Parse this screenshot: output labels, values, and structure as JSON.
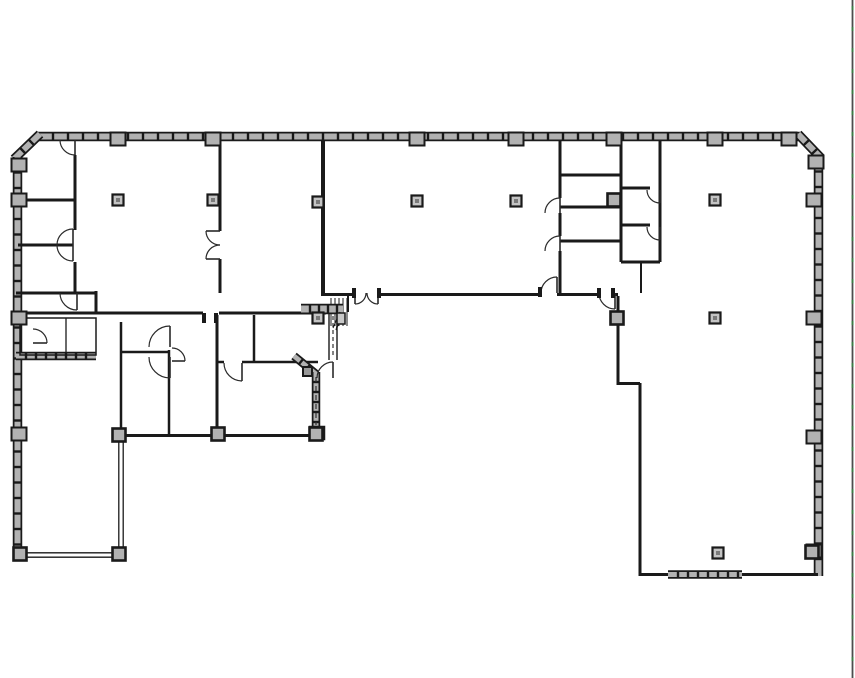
{
  "drawing": {
    "type": "floor-plan",
    "canvas": {
      "width": 855,
      "height": 678,
      "background": "#ffffff"
    },
    "colors": {
      "wall_line": "#1a1a1a",
      "hatch_fill": "#b2b2b2",
      "column_fill": "#c4c4c4",
      "column_core": "#7a7a7a",
      "door_arc": "#2a2a2a",
      "border_line": "#4d4d4d",
      "border_dash": "#3a7d44"
    },
    "exterior_walls": [
      {
        "x1": 38,
        "y1": 136.5,
        "x2": 800,
        "y2": 136.5,
        "w": 7,
        "tick": 15
      },
      {
        "x1": 40,
        "y1": 134,
        "x2": 14,
        "y2": 159,
        "w": 7,
        "tick": 12
      },
      {
        "x1": 17.5,
        "y1": 157,
        "x2": 17.5,
        "y2": 555,
        "w": 7,
        "tick": 15.5
      },
      {
        "x1": 798,
        "y1": 134,
        "x2": 821,
        "y2": 158,
        "w": 7,
        "tick": 12
      },
      {
        "x1": 818.5,
        "y1": 156,
        "x2": 818.5,
        "y2": 576,
        "w": 7,
        "tick": 15.5
      }
    ],
    "hatch_overlays": [
      {
        "x1": 301,
        "y1": 309,
        "x2": 343,
        "y2": 309,
        "w": 8,
        "tick": 9
      },
      {
        "x1": 294,
        "y1": 356,
        "x2": 316,
        "y2": 374,
        "w": 6,
        "tick": 9
      },
      {
        "x1": 316,
        "y1": 372,
        "x2": 316,
        "y2": 430,
        "w": 6,
        "tick": 10
      },
      {
        "x1": 668,
        "y1": 574.5,
        "x2": 742,
        "y2": 574.5,
        "w": 6,
        "tick": 10
      },
      {
        "x1": 16,
        "y1": 356,
        "x2": 96,
        "y2": 356,
        "w": 6,
        "tick": 10
      }
    ],
    "interior_walls": [
      [
        75,
        155,
        75,
        230
      ],
      [
        75,
        262,
        75,
        294
      ],
      [
        21,
        200,
        75,
        200
      ],
      [
        18,
        245,
        73,
        245
      ],
      [
        16,
        293,
        96,
        293
      ],
      [
        96,
        291,
        96,
        314
      ],
      [
        16,
        313,
        203,
        313
      ],
      [
        219,
        313,
        326,
        313
      ],
      [
        121,
        322,
        121,
        437,
        2.5
      ],
      [
        122,
        352,
        169,
        352,
        2.5
      ],
      [
        169,
        350,
        169,
        437,
        2.5
      ],
      [
        217,
        315,
        217,
        437
      ],
      [
        217,
        362,
        224,
        362,
        2.5
      ],
      [
        242,
        362,
        318,
        362,
        2.5
      ],
      [
        254,
        315,
        254,
        362,
        2.5
      ],
      [
        122,
        435.5,
        323,
        435.5
      ],
      [
        220,
        140,
        220,
        231
      ],
      [
        220,
        259,
        220,
        293
      ],
      [
        323,
        140,
        323,
        296,
        4
      ],
      [
        325,
        294.5,
        355,
        294.5
      ],
      [
        378,
        294.5,
        541,
        294.5
      ],
      [
        557,
        294.5,
        563,
        294.5
      ],
      [
        560,
        140,
        560,
        198
      ],
      [
        560,
        213,
        560,
        236
      ],
      [
        560,
        251,
        560,
        296
      ],
      [
        560,
        175,
        621,
        175
      ],
      [
        560,
        207,
        621,
        207
      ],
      [
        560,
        241,
        621,
        241
      ],
      [
        560,
        294.5,
        599,
        294.5
      ],
      [
        613,
        294.5,
        618,
        294.5
      ],
      [
        621,
        140,
        621,
        262
      ],
      [
        660,
        140,
        660,
        262
      ],
      [
        621,
        188,
        650,
        188
      ],
      [
        621,
        225,
        650,
        225
      ],
      [
        621,
        262,
        660,
        262
      ],
      [
        641,
        262,
        641,
        293,
        2
      ],
      [
        618,
        296,
        618,
        385
      ],
      [
        618,
        383.5,
        640,
        383.5
      ],
      [
        640,
        383,
        640,
        576
      ],
      [
        640,
        574.5,
        818,
        574.5
      ]
    ],
    "thin_lines": [
      [
        66,
        318,
        66,
        355,
        1.3
      ],
      [
        329,
        313,
        329,
        360,
        1.4
      ],
      [
        337,
        313,
        337,
        360,
        1.4
      ],
      [
        348,
        296,
        348,
        312,
        2
      ],
      [
        118.8,
        437,
        118.8,
        556,
        1.3
      ],
      [
        123.2,
        437,
        123.2,
        556,
        1.3
      ],
      [
        16,
        552.8,
        122,
        552.8,
        1.4
      ],
      [
        16,
        557.2,
        122,
        557.2,
        1.4
      ],
      [
        331,
        298,
        331,
        326,
        1
      ],
      [
        335,
        298,
        335,
        326,
        1
      ],
      [
        339,
        298,
        339,
        326,
        1
      ],
      [
        343,
        298,
        343,
        326,
        1
      ],
      [
        347,
        298,
        347,
        326,
        1
      ]
    ],
    "dashed_lines": [
      [
        333,
        316,
        333,
        357,
        "4 3"
      ],
      [
        316,
        377,
        316,
        425,
        "5 4"
      ]
    ],
    "polylines": [
      {
        "points": [
          [
            333,
            328
          ],
          [
            340,
            312
          ],
          [
            336,
            330
          ],
          [
            343,
            314
          ]
        ],
        "w": 1
      }
    ],
    "rects": [
      {
        "x": 20,
        "y": 318,
        "w": 76,
        "h": 37,
        "fill": "none",
        "stroke": 1.5
      },
      {
        "x": 337,
        "y": 313,
        "w": 8,
        "h": 11,
        "fill": "#c8c8c8",
        "stroke": 1.5
      },
      {
        "x": 310,
        "y": 427,
        "w": 14,
        "h": 12,
        "fill": "#b2b2b2",
        "stroke": 2.5
      },
      {
        "x": 303,
        "y": 367,
        "w": 9,
        "h": 9,
        "fill": "#999999",
        "stroke": 2
      }
    ],
    "columns_free": [
      [
        118,
        200
      ],
      [
        213,
        200
      ],
      [
        318,
        202
      ],
      [
        417,
        201
      ],
      [
        516,
        201
      ],
      [
        715,
        200
      ],
      [
        715,
        318
      ],
      [
        718,
        553
      ],
      [
        318,
        318
      ]
    ],
    "columns_wall": [
      [
        119,
        435
      ],
      [
        218,
        434
      ],
      [
        316,
        434
      ],
      [
        119,
        554
      ],
      [
        20,
        554
      ],
      [
        812,
        552
      ],
      [
        617,
        318
      ],
      [
        614,
        200
      ]
    ],
    "sill_boxes": [
      [
        118,
        139
      ],
      [
        213,
        139
      ],
      [
        417,
        139
      ],
      [
        516,
        139
      ],
      [
        614,
        139
      ],
      [
        715,
        139
      ],
      [
        789,
        139
      ],
      [
        19,
        165
      ],
      [
        19,
        200
      ],
      [
        19,
        318
      ],
      [
        19,
        434
      ],
      [
        814,
        200
      ],
      [
        814,
        318
      ],
      [
        814,
        437
      ],
      [
        814,
        551
      ],
      [
        816,
        162
      ]
    ],
    "door_jambs": [
      [
        354,
        289
      ],
      [
        379,
        289
      ],
      [
        540,
        288
      ],
      [
        204,
        314
      ],
      [
        216,
        314
      ],
      [
        599,
        289
      ],
      [
        613,
        289
      ]
    ],
    "doors": [
      {
        "c": [
          75,
          140
        ],
        "r": 15,
        "from": 90,
        "to": 180,
        "leaf": 90
      },
      {
        "c": [
          73,
          245
        ],
        "r": 16,
        "from": 180,
        "to": 270,
        "leaf": 270
      },
      {
        "c": [
          73,
          245
        ],
        "r": 16,
        "from": 90,
        "to": 180,
        "leaf": 90
      },
      {
        "c": [
          77,
          293
        ],
        "r": 17,
        "from": 180,
        "to": 90,
        "leaf": 90
      },
      {
        "c": [
          33,
          343
        ],
        "r": 14,
        "from": 270,
        "to": 0,
        "leaf": 0
      },
      {
        "c": [
          220,
          231
        ],
        "r": 14,
        "from": 180,
        "to": 90,
        "leaf": 180
      },
      {
        "c": [
          220,
          259
        ],
        "r": 14,
        "from": 270,
        "to": 180,
        "leaf": 180
      },
      {
        "c": [
          170,
          347
        ],
        "r": 21,
        "from": 180,
        "to": 270,
        "leaf": 270
      },
      {
        "c": [
          170,
          357
        ],
        "r": 21,
        "from": 90,
        "to": 180,
        "leaf": 90
      },
      {
        "c": [
          172,
          361
        ],
        "r": 13,
        "from": 270,
        "to": 0,
        "leaf": 0
      },
      {
        "c": [
          242,
          363
        ],
        "r": 18,
        "from": 180,
        "to": 90,
        "leaf": 90
      },
      {
        "c": [
          333,
          378
        ],
        "r": 16,
        "from": 270,
        "to": 180,
        "leaf": 270
      },
      {
        "c": [
          355,
          293
        ],
        "r": 11,
        "from": 0,
        "to": 90,
        "leaf": 90
      },
      {
        "c": [
          378,
          293
        ],
        "r": 11,
        "from": 180,
        "to": 90,
        "leaf": 90
      },
      {
        "c": [
          557,
          293
        ],
        "r": 16,
        "from": 180,
        "to": 270,
        "leaf": 270
      },
      {
        "c": [
          560,
          213
        ],
        "r": 15,
        "from": 180,
        "to": 270,
        "leaf": 270
      },
      {
        "c": [
          560,
          251
        ],
        "r": 15,
        "from": 180,
        "to": 270,
        "leaf": 270
      },
      {
        "c": [
          660,
          190
        ],
        "r": 13,
        "from": 180,
        "to": 90,
        "leaf": 90
      },
      {
        "c": [
          660,
          227
        ],
        "r": 13,
        "from": 180,
        "to": 90,
        "leaf": 90
      },
      {
        "c": [
          615,
          293
        ],
        "r": 16,
        "from": 180,
        "to": 90,
        "leaf": 90
      }
    ],
    "viewport_border": {
      "x": 852.5,
      "y1": 0,
      "y2": 678,
      "dash": "4 17"
    }
  }
}
